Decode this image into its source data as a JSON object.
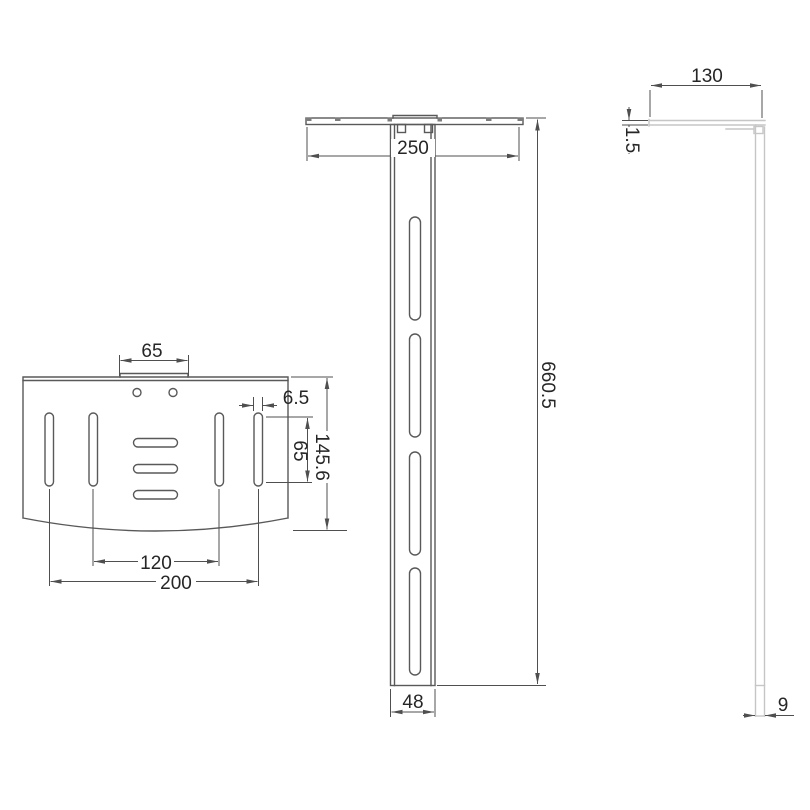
{
  "drawing": {
    "kind": "technical-drawing",
    "colors": {
      "background": "#ffffff",
      "part_line": "#595959",
      "part_line_light": "#c6c6c6",
      "dimension_line": "#4f4f4f",
      "text": "#262626"
    },
    "views": {
      "shelf_top_view": {
        "dimensions": {
          "mount_tab_width": "65",
          "slot_width": "6.5",
          "slot_length": "65",
          "plate_depth": "145.6",
          "inner_slot_spacing": "120",
          "outer_slot_spacing": "200"
        }
      },
      "bracket_front_view": {
        "dimensions": {
          "shelf_width": "250",
          "overall_height": "660.5",
          "upright_width": "48"
        }
      },
      "bracket_side_view": {
        "dimensions": {
          "shelf_depth": "130",
          "plate_thickness": "1.5",
          "upright_thickness": "9"
        }
      }
    }
  }
}
